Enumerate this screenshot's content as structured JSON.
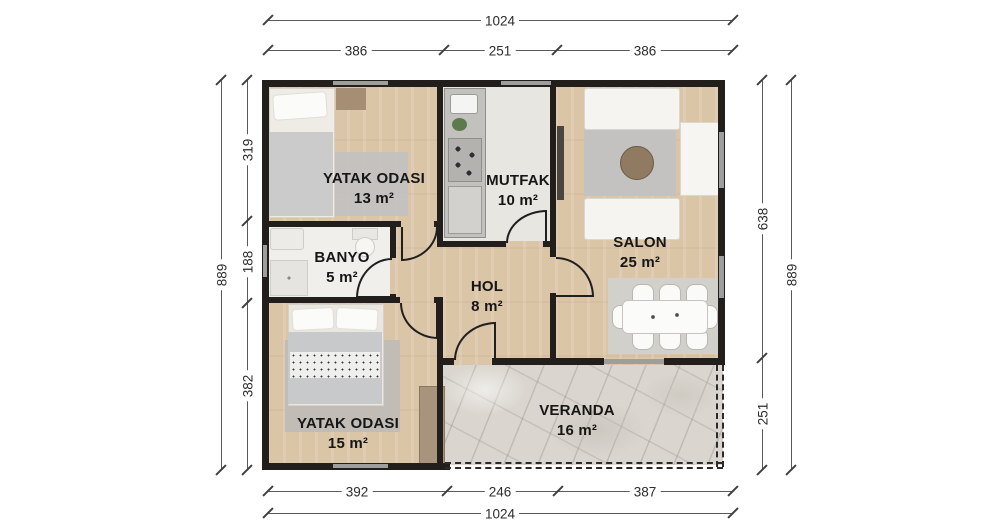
{
  "rooms": {
    "bedroom1": {
      "name": "YATAK ODASI",
      "area": "13 m²"
    },
    "kitchen": {
      "name": "MUTFAK",
      "area": "10 m²"
    },
    "salon": {
      "name": "SALON",
      "area": "25 m²"
    },
    "bathroom": {
      "name": "BANYO",
      "area": "5 m²"
    },
    "hall": {
      "name": "HOL",
      "area": "8 m²"
    },
    "bedroom2": {
      "name": "YATAK ODASI",
      "area": "15 m²"
    },
    "veranda": {
      "name": "VERANDA",
      "area": "16 m²"
    }
  },
  "dimensions": {
    "top": {
      "total": "1024",
      "segments": [
        "386",
        "251",
        "386"
      ]
    },
    "bottom": {
      "total": "1024",
      "segments": [
        "392",
        "246",
        "387"
      ]
    },
    "left": {
      "total": "889",
      "segments": [
        "319",
        "188",
        "382"
      ]
    },
    "right": {
      "total": "889",
      "segments": [
        "638",
        "251"
      ]
    }
  },
  "colors": {
    "wall": "#211e1b",
    "wood_floor": "#dbc5a7",
    "kitchen_floor": "#e8e6e1",
    "bath_floor": "#f1efec",
    "veranda_floor": "#dad6cf",
    "window": "#9e9e9e"
  }
}
